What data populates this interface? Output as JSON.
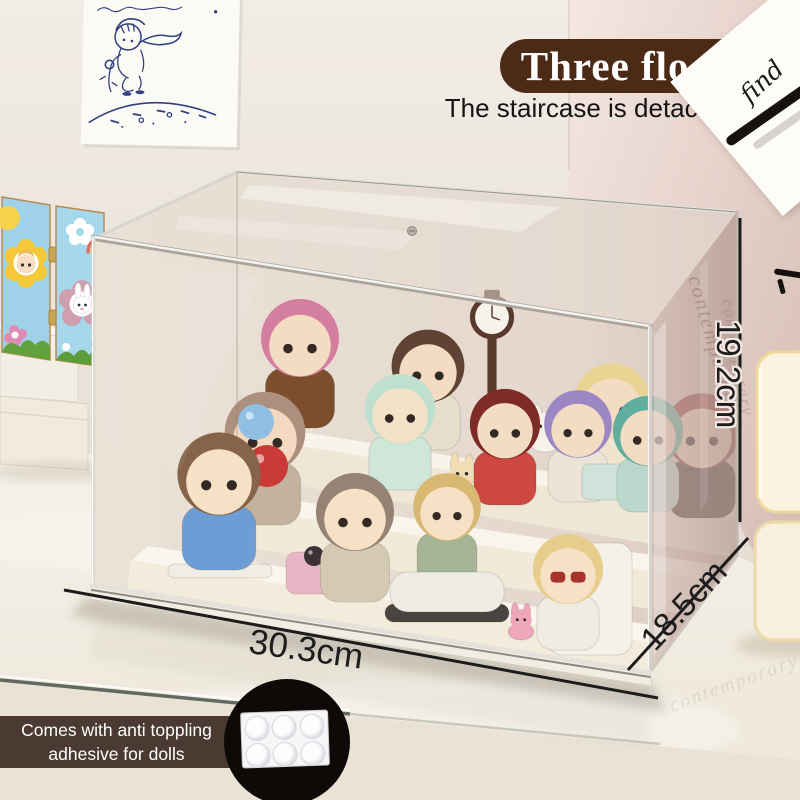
{
  "overlay": {
    "floors_badge": "Three floors",
    "subtitle": "The staircase is detachable",
    "width_label": "30.3cm",
    "height_label": "19.2cm",
    "depth_label": "18.5cm",
    "banner_line1": "Comes with anti toppling",
    "banner_line2": "adhesive for dolls"
  },
  "wall_card": {
    "handwritten_word": "find"
  },
  "reflections": {
    "acrylic_word_1": "contemporary",
    "acrylic_word_2": "contemporary",
    "table_word": "contemporary",
    "embossed_1": "CO",
    "embossed_2": "OR"
  },
  "colors": {
    "badge_brown": "#4c2b16",
    "banner_brown": "#4b3a32",
    "sketch_ink": "#32417f",
    "measure_black": "#1c1c1c"
  },
  "figurines": [
    {
      "type": "kid",
      "name": "figurine-pink-hair-organ-kid",
      "x": 300,
      "y": 428,
      "s": 1.5,
      "hat": "#d47fa0",
      "skin": "#f4dcc3",
      "body": "#7d4e2e"
    },
    {
      "type": "kid",
      "name": "figurine-drip-hat-boy",
      "x": 428,
      "y": 450,
      "s": 1.4,
      "hat": "#5f4334",
      "skin": "#f4dcc3",
      "body": "#e6ddcb"
    },
    {
      "type": "clock",
      "name": "figurine-street-clock",
      "x": 492,
      "y": 468,
      "s": 1.3,
      "color": "#5a3a2c"
    },
    {
      "type": "bunny",
      "name": "figurine-white-bunny",
      "x": 545,
      "y": 452,
      "s": 0.95,
      "color": "#f6f2ea"
    },
    {
      "type": "kid",
      "name": "figurine-cream-sweater-boy",
      "x": 612,
      "y": 488,
      "s": 1.45,
      "hat": "#e9d494",
      "skin": "#f4dcc3",
      "body": "#efe5cf"
    },
    {
      "type": "ball",
      "name": "figurine-red-flower",
      "x": 660,
      "y": 462,
      "r": 11,
      "color": "#b5372b"
    },
    {
      "type": "kid",
      "name": "figurine-red-hair-kid",
      "x": 702,
      "y": 518,
      "s": 1.45,
      "hat": "#97423c",
      "skin": "#efd5bb",
      "body": "#4a3b36"
    },
    {
      "type": "ball",
      "name": "macaron-hat",
      "x": 263,
      "y": 446,
      "r": 15,
      "color": "#4fa3b5"
    },
    {
      "type": "kid",
      "name": "figurine-macaron-hat-kid",
      "x": 265,
      "y": 525,
      "s": 1.55,
      "hat": "#ac8f7c",
      "skin": "#f2d9bf",
      "body": "#c3b29d"
    },
    {
      "type": "kid",
      "name": "figurine-teapot-kid",
      "x": 400,
      "y": 490,
      "s": 1.35,
      "hat": "#bfe0cf",
      "skin": "#f2e2c6",
      "body": "#cfe7d9"
    },
    {
      "type": "bunny",
      "name": "figurine-cream-bunny",
      "x": 462,
      "y": 498,
      "s": 0.9,
      "color": "#f2ddb4"
    },
    {
      "type": "kid",
      "name": "figurine-berry-hat-boy",
      "x": 505,
      "y": 505,
      "s": 1.35,
      "hat": "#7e2a28",
      "skin": "#f2dcc2",
      "body": "#cc4840"
    },
    {
      "type": "kid",
      "name": "figurine-icecream-kid",
      "x": 578,
      "y": 502,
      "s": 1.3,
      "hat": "#9d86c4",
      "skin": "#f2dcc2",
      "body": "#ece4d6"
    },
    {
      "type": "prop",
      "name": "icecream-cart",
      "x": 608,
      "y": 500,
      "w": 52,
      "h": 36,
      "rad": 7,
      "color": "#cfe3da"
    },
    {
      "type": "kid",
      "name": "figurine-striped-hat-kid",
      "x": 648,
      "y": 512,
      "s": 1.35,
      "hat": "#5fae9f",
      "skin": "#f2dcc2",
      "body": "#bcd8cd"
    },
    {
      "type": "ball",
      "name": "blue-balloon",
      "x": 256,
      "y": 440,
      "r": 18,
      "color": "#8fc0e4"
    },
    {
      "type": "ball",
      "name": "red-heart-balloon",
      "x": 267,
      "y": 487,
      "r": 21,
      "color": "#c93a38"
    },
    {
      "type": "prop",
      "name": "round-base",
      "x": 220,
      "y": 578,
      "w": 104,
      "h": 14,
      "rad": 7,
      "color": "#f2ede2"
    },
    {
      "type": "kid",
      "name": "figurine-bear-hoodie-kid",
      "x": 219,
      "y": 570,
      "s": 1.6,
      "hat": "#86644a",
      "skin": "#f6e0c6",
      "body": "#6e9cd4"
    },
    {
      "type": "prop",
      "name": "stroller",
      "x": 313,
      "y": 594,
      "w": 54,
      "h": 42,
      "rad": 10,
      "color": "#e7b7c6"
    },
    {
      "type": "ball",
      "name": "cat-in-stroller",
      "x": 314,
      "y": 566,
      "r": 10,
      "color": "#3c3238"
    },
    {
      "type": "kid",
      "name": "figurine-stroller-kid",
      "x": 355,
      "y": 602,
      "s": 1.5,
      "hat": "#968374",
      "skin": "#f6e0c6",
      "body": "#d4c9b2"
    },
    {
      "type": "kid",
      "name": "figurine-bumper-car-boy",
      "x": 447,
      "y": 585,
      "s": 1.3,
      "hat": "#d8b873",
      "skin": "#f6e0c6",
      "body": "#a4b494"
    },
    {
      "type": "prop",
      "name": "car-tire",
      "x": 447,
      "y": 622,
      "w": 124,
      "h": 18,
      "rad": 9,
      "color": "#4a4440"
    },
    {
      "type": "prop",
      "name": "bumper-car",
      "x": 447,
      "y": 612,
      "w": 114,
      "h": 40,
      "rad": 18,
      "color": "#efece3"
    },
    {
      "type": "prop",
      "name": "photo-chair",
      "x": 590,
      "y": 655,
      "w": 84,
      "h": 112,
      "rad": 14,
      "color": "#f4f1ea"
    },
    {
      "type": "bunny",
      "name": "figurine-pink-bunny",
      "x": 521,
      "y": 640,
      "s": 0.75,
      "color": "#eda6ba"
    },
    {
      "type": "kid",
      "name": "figurine-sunglasses-girl",
      "x": 568,
      "y": 650,
      "s": 1.35,
      "hat": "#e7cd8c",
      "skin": "#f6e0c6",
      "body": "#f1ece2",
      "glasses": "#a8322c"
    }
  ]
}
